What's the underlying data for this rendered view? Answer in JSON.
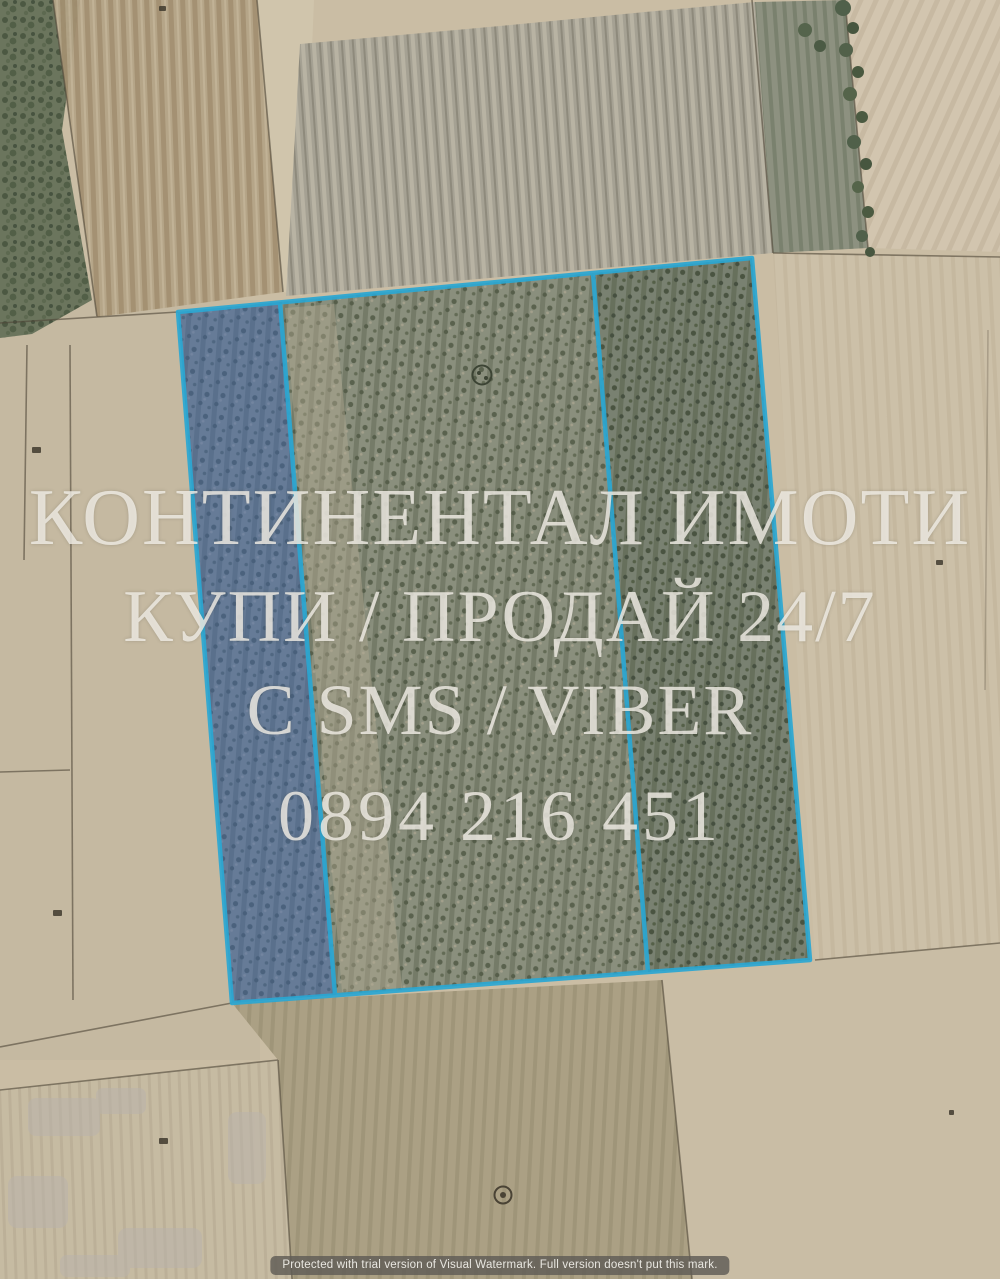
{
  "watermark": {
    "line1": "КОНТИНЕНТАЛ ИМОТИ",
    "line2": "КУПИ / ПРОДАЙ 24/7",
    "line3": "С SMS / VIBER",
    "line4": "0894 216 451",
    "text_color": "#f0ede5"
  },
  "trial_notice": {
    "text": "Protected with trial version of Visual Watermark. Full version doesn't put this mark."
  },
  "map": {
    "kind": "satellite-cadastral-view",
    "parcel_outline_color": "#2aa7d3",
    "parcel_highlight_fill_color": "#3a64b9",
    "field_base_color": "#cabda4"
  }
}
